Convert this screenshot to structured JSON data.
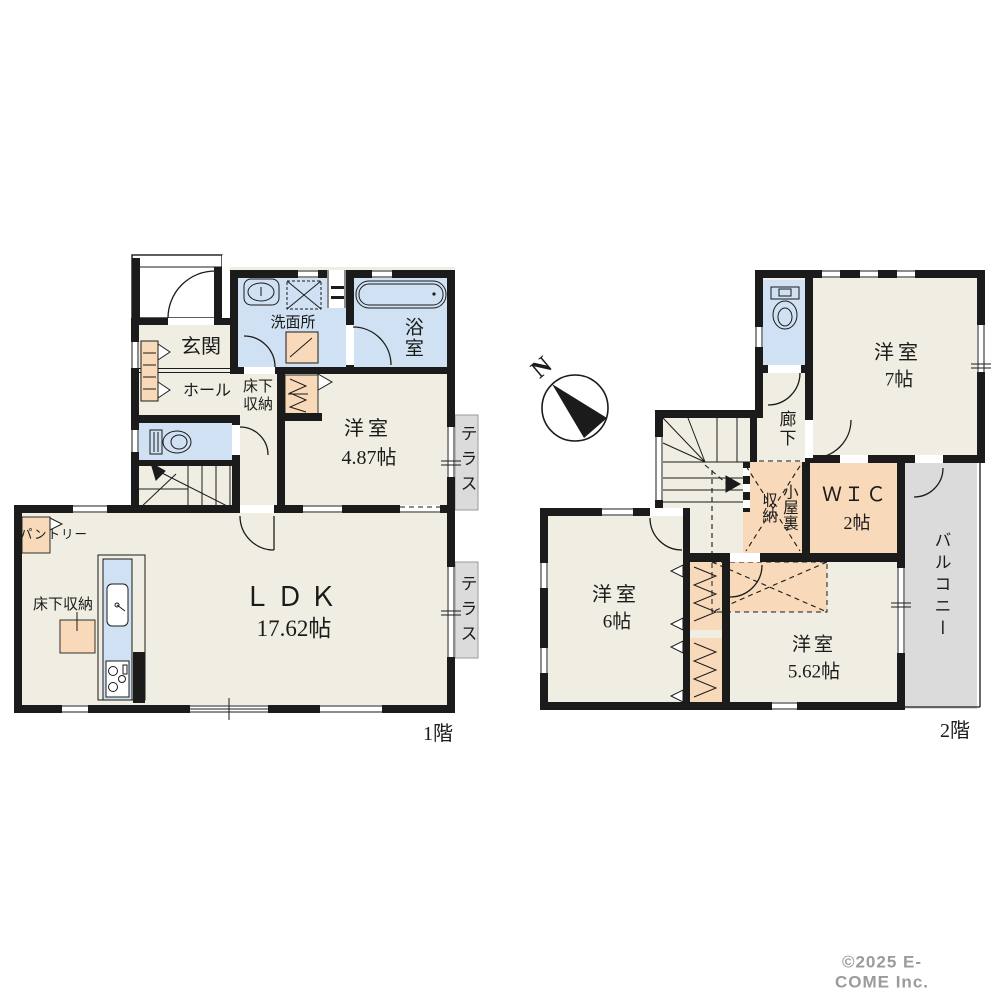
{
  "colors": {
    "wall": "#1b1b1b",
    "room_floor": "#f0eee2",
    "wet_area": "#cfe1f2",
    "storage": "#f8d9ba",
    "terrace": "#dbdbdb",
    "text": "#1b1b1b",
    "copyright_text": "#9b9b9b"
  },
  "compass": {
    "north_label": "N"
  },
  "floor1": {
    "name": "1階",
    "entrance": {
      "label": "玄関"
    },
    "hall": {
      "label": "ホール"
    },
    "underfloor_storage_hall": {
      "label": "床下\n収納"
    },
    "washroom": {
      "label": "洗面所"
    },
    "bathroom": {
      "label": "浴室"
    },
    "western_room": {
      "label": "洋室",
      "size": "4.87帖"
    },
    "ldk": {
      "label": "ＬＤＫ",
      "size": "17.62帖"
    },
    "pantry": {
      "label": "パントリー"
    },
    "underfloor_storage_ldk": {
      "label": "床下収納"
    },
    "terrace_upper": {
      "label": "テラス"
    },
    "terrace_lower": {
      "label": "テラス"
    }
  },
  "floor2": {
    "name": "2階",
    "western_room_7": {
      "label": "洋室",
      "size": "7帖"
    },
    "corridor": {
      "label": "廊下"
    },
    "attic_storage": {
      "label": "小屋裏\n収納"
    },
    "wic": {
      "label": "ＷＩＣ",
      "size": "2帖"
    },
    "balcony": {
      "label": "バルコニー"
    },
    "western_room_6": {
      "label": "洋室",
      "size": "6帖"
    },
    "western_room_562": {
      "label": "洋室",
      "size": "5.62帖"
    }
  },
  "copyright": "©2025 E-COME Inc."
}
